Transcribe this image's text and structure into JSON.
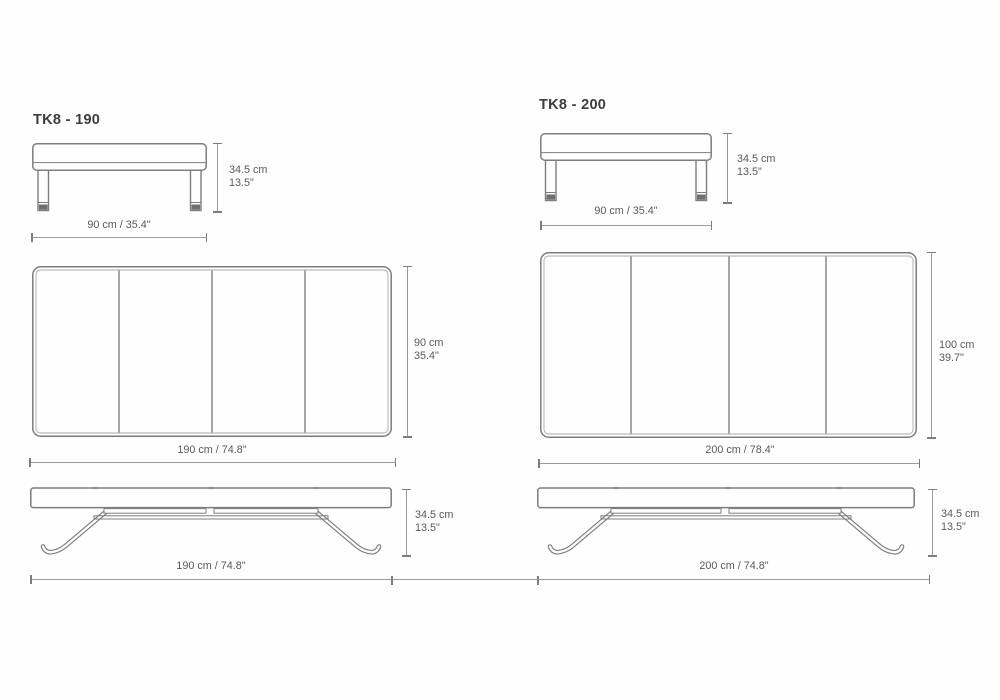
{
  "sheet": {
    "type": "furniture-dimension-drawing"
  },
  "products": [
    {
      "title": "TK8 - 190",
      "side_view": {
        "height_cm": "34.5 cm",
        "height_in": "13.5\"",
        "width_label": "90 cm / 35.4\""
      },
      "top_view": {
        "depth_cm": "90 cm",
        "depth_in": "35.4\"",
        "width_label": "190 cm / 74.8\""
      },
      "front_view": {
        "height_cm": "34.5 cm",
        "height_in": "13.5\"",
        "width_label": "190 cm / 74.8\""
      }
    },
    {
      "title": "TK8 - 200",
      "side_view": {
        "height_cm": "34.5 cm",
        "height_in": "13.5\"",
        "width_label": "90 cm / 35.4\""
      },
      "top_view": {
        "depth_cm": "100 cm",
        "depth_in": "39.7\"",
        "width_label": "200 cm / 78.4\""
      },
      "front_view": {
        "height_cm": "34.5 cm",
        "height_in": "13.5\"",
        "width_label": "200 cm / 74.8\""
      }
    }
  ],
  "colors": {
    "drawing_line": "#7d7d7d",
    "dim_line": "#9b9b9b",
    "dim_text": "#595959",
    "title_text": "#3d3d3d",
    "foot_cap": "#6f6f6f"
  }
}
